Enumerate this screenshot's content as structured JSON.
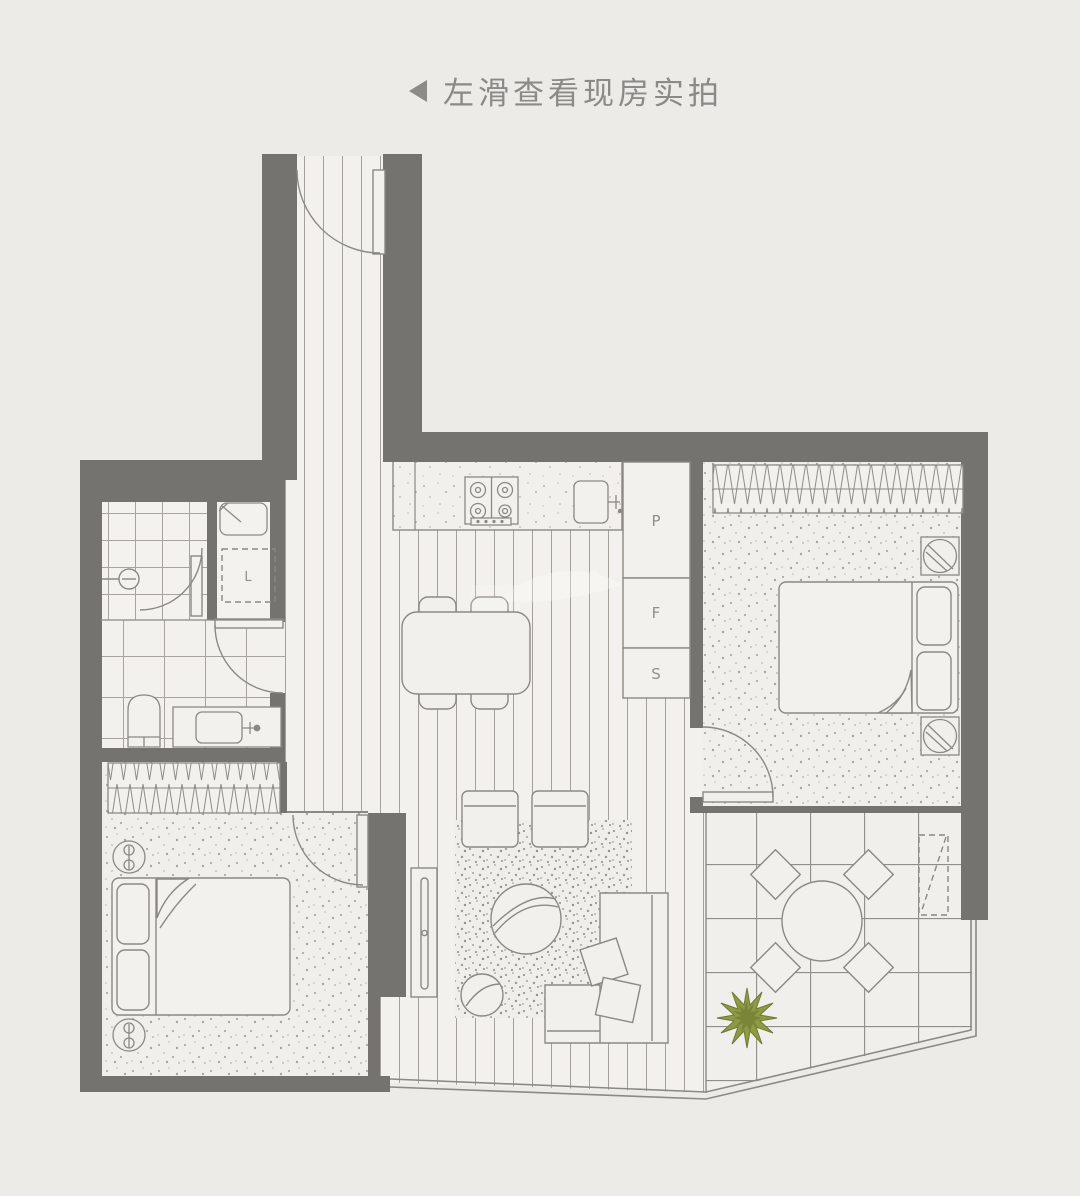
{
  "hint": {
    "arrow": "left-triangle",
    "text": "左滑查看现房实拍"
  },
  "floorplan": {
    "labels": {
      "p": "P",
      "f": "F",
      "s": "S",
      "washer": "L"
    },
    "colors": {
      "background": "#ecebe8",
      "wall": "#75736f",
      "line": "#8b8984",
      "floor": "#f2f0ed",
      "plant_green": "#8f9a45"
    }
  }
}
